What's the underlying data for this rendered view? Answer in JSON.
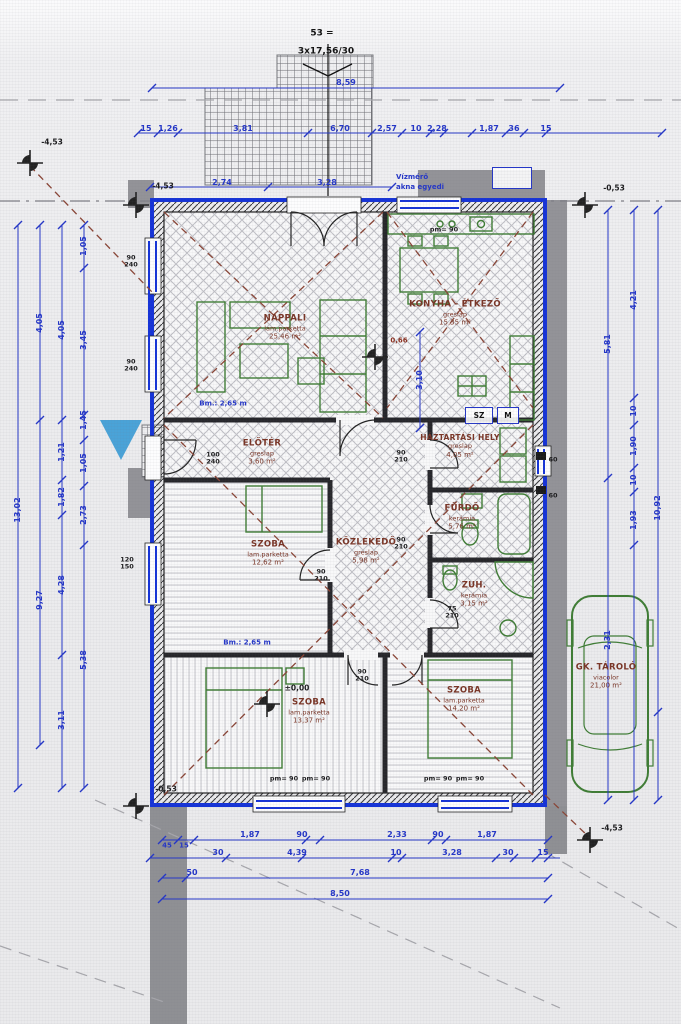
{
  "stair": {
    "count": "53 =",
    "note": "3x17,56/30"
  },
  "survey": {
    "lvl_tl": "-4,53",
    "lvl_tl2": "-4,53",
    "lvl_tr": "-0,53",
    "lvl_bl": "-0,53",
    "lvl_br": "-4,53",
    "lvl_zero": "±0,00"
  },
  "notes": {
    "bm1": "Bm.: 2,65 m",
    "bm2": "Bm.: 2,65 m",
    "meter1": "Vízmérő",
    "meter2": "akna egyedi",
    "sz": "SZ",
    "m": "M"
  },
  "rooms": [
    {
      "name": "NAPPALI",
      "finish": "lam.parketta",
      "area": "25,46 m²"
    },
    {
      "name": "KONYHA - ÉTKEZŐ",
      "finish": "greslap",
      "area": "15,35 m²"
    },
    {
      "name": "ELŐTÉR",
      "finish": "greslap",
      "area": "3,60 m²"
    },
    {
      "name": "HÁZTARTÁSI HELY",
      "finish": "greslap",
      "area": "4,05 m²"
    },
    {
      "name": "FÜRDŐ",
      "finish": "kerámia",
      "area": "5,76 m²"
    },
    {
      "name": "SZOBA",
      "finish": "lam.parketta",
      "area": "12,62 m²"
    },
    {
      "name": "KÖZLEKEDŐ",
      "finish": "greslap",
      "area": "5,98 m²"
    },
    {
      "name": "ZUH.",
      "finish": "kerámia",
      "area": "3,15 m²"
    },
    {
      "name": "SZOBA",
      "finish": "lam.parketta",
      "area": "13,37 m²"
    },
    {
      "name": "SZOBA",
      "finish": "lam.parketta",
      "area": "14,20 m²"
    },
    {
      "name": "GK. TÁROLÓ",
      "finish": "viacolor",
      "area": "21,00 m²"
    }
  ],
  "openings": {
    "win_lt": [
      "90",
      "240"
    ],
    "win_lm": [
      "90",
      "240"
    ],
    "win_low": [
      "120",
      "150"
    ],
    "door_entry": [
      "100",
      "240"
    ],
    "door_a": [
      "90",
      "210"
    ],
    "door_b": [
      "90",
      "210"
    ],
    "door_c": [
      "90",
      "210"
    ],
    "door_d": [
      "75",
      "210"
    ],
    "door_e": [
      "90",
      "210"
    ],
    "pm": "pm= 90",
    "vent": "60"
  },
  "dims": {
    "top1": [
      "15",
      "1,26",
      "3,81",
      "6,70",
      "2,57",
      "10",
      "2,28",
      "1,87",
      "36",
      "15"
    ],
    "top2": [
      "2,74",
      "3,28"
    ],
    "terrace": "8,59",
    "bottom1": [
      "45",
      "15",
      "1,87",
      "90",
      "2,33",
      "90",
      "1,87"
    ],
    "bottom2": [
      "30",
      "4,39",
      "10",
      "3,28",
      "30",
      "15"
    ],
    "bottom3": [
      "50",
      "7,68"
    ],
    "bottom4": [
      "8,50"
    ],
    "left1": [
      "13,02"
    ],
    "left2": [
      "4,05",
      "9,27"
    ],
    "left3": [
      "4,05",
      "1,21",
      "1,82",
      "4,28",
      "3,11"
    ],
    "left4": [
      "1,05",
      "3,45",
      "1,45",
      "1,05",
      "2,73",
      "5,38"
    ],
    "right1": [
      "5,81",
      "2,31"
    ],
    "right2": [
      "4,21",
      "10",
      "1,90",
      "10",
      "1,93"
    ],
    "right3": [
      "10,92"
    ],
    "inner_v": "3,10",
    "inner_r": "0,66"
  }
}
